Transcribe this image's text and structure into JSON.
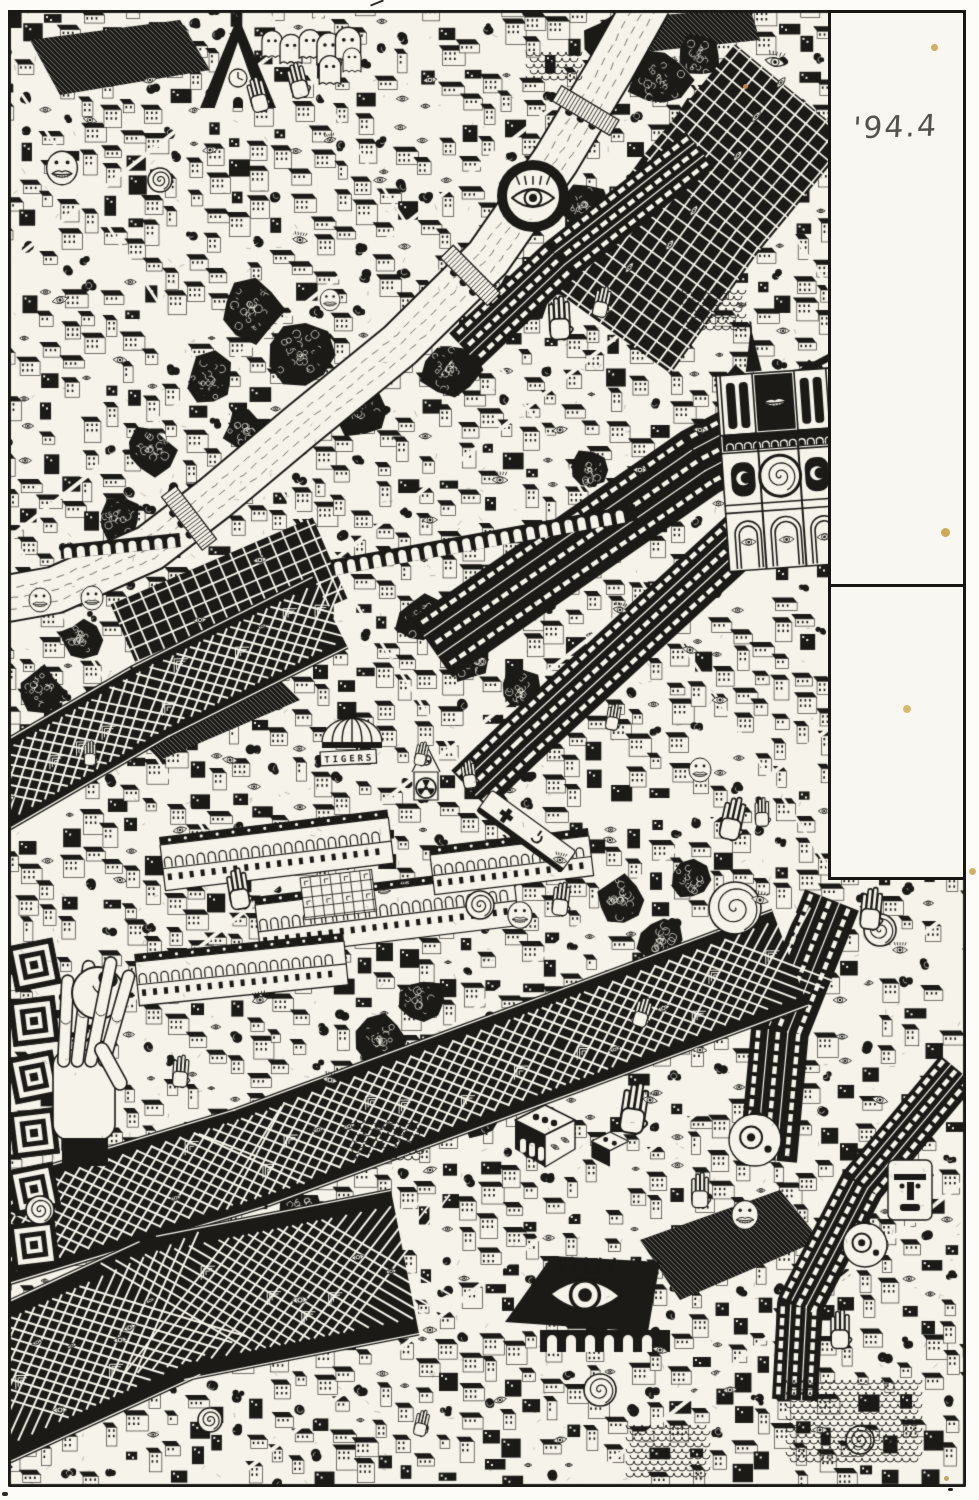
{
  "page": {
    "width": 979,
    "height": 1500,
    "background": "#fdfcf8",
    "paper": "#f6f3ea",
    "ink": "#1b1a17",
    "stain": "#c79b3f"
  },
  "margin_panel": {
    "page_label": "'94.4"
  },
  "artwork": {
    "dome_banner_text": "TIGERS",
    "motif_icons": [
      "eye-icon",
      "hand-icon",
      "ghost-icon",
      "lips-face-icon",
      "spiral-icon",
      "dice-icon",
      "cathedral-icon",
      "dome-icon",
      "fan-blade-icon",
      "cross-icon",
      "bridge-icon",
      "tree-icon",
      "fish-face-icon",
      "totem-face-icon",
      "eyeball-icon",
      "lattice-icon",
      "arcade-icon",
      "river-icon"
    ]
  }
}
